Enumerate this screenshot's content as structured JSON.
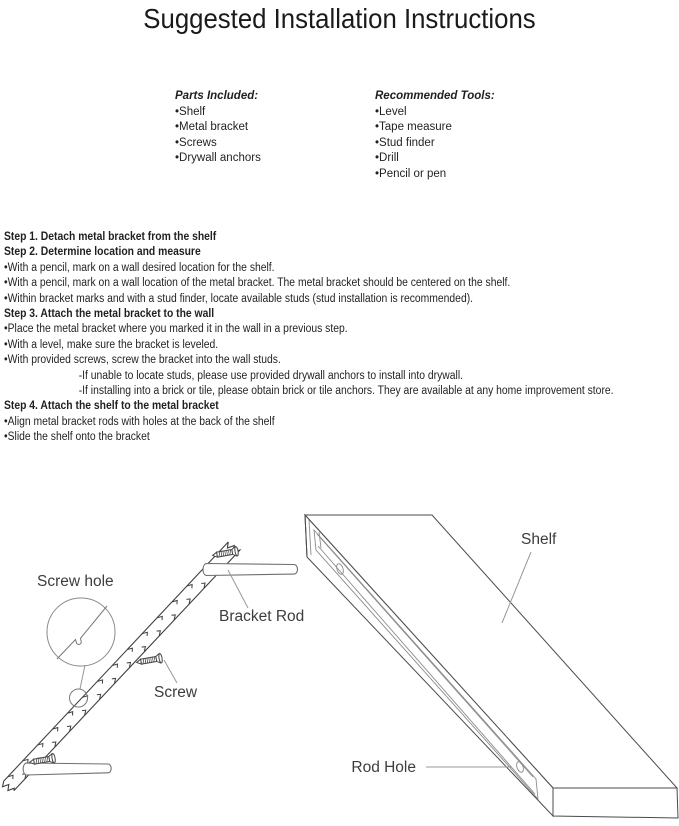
{
  "title": "Suggested Installation Instructions",
  "parts": {
    "heading": "Parts Included:",
    "items": [
      "•Shelf",
      "•Metal bracket",
      "•Screws",
      "•Drywall anchors"
    ]
  },
  "tools": {
    "heading": "Recommended Tools:",
    "items": [
      "•Level",
      "•Tape measure",
      "•Stud finder",
      "•Drill",
      "•Pencil or pen"
    ]
  },
  "steps": {
    "lines": [
      {
        "style": "heading",
        "text": "Step 1. Detach metal bracket from the shelf"
      },
      {
        "style": "heading",
        "text": "Step 2. Determine location and measure"
      },
      {
        "style": "bullet",
        "text": "•With a pencil, mark on a wall desired location for the shelf."
      },
      {
        "style": "bullet",
        "text": "•With a pencil, mark on a wall location of the metal bracket. The metal bracket should be centered on the shelf."
      },
      {
        "style": "bullet",
        "text": "•Within bracket marks and with a stud finder, locate available studs (stud installation is recommended)."
      },
      {
        "style": "heading",
        "text": "Step 3. Attach the metal bracket to the wall"
      },
      {
        "style": "bullet",
        "text": "•Place the metal bracket where you marked it in the wall in a previous step."
      },
      {
        "style": "bullet",
        "text": "•With a level, make sure the bracket is leveled."
      },
      {
        "style": "bullet",
        "text": "•With provided screws, screw the bracket into the wall studs."
      },
      {
        "style": "indent",
        "text": "-If unable to locate studs, please use provided drywall anchors to install into drywall."
      },
      {
        "style": "indent",
        "text": "-If installing into a brick or tile, please obtain brick or tile anchors. They are available at any home improvement store."
      },
      {
        "style": "heading",
        "text": "Step 4. Attach the shelf to the metal bracket"
      },
      {
        "style": "bullet",
        "text": "•Align metal bracket rods with holes at the back of the shelf"
      },
      {
        "style": "bullet",
        "text": "•Slide the shelf onto the bracket"
      }
    ]
  },
  "diagram": {
    "labels": {
      "screw_hole": "Screw hole",
      "bracket_rod": "Bracket Rod",
      "screw": "Screw",
      "shelf": "Shelf",
      "rod_hole": "Rod Hole"
    }
  },
  "colors": {
    "ink": "#231f20",
    "diagram_dark": "#4b4b4d",
    "diagram_mid": "#77787b",
    "diagram_light": "#97989a"
  }
}
